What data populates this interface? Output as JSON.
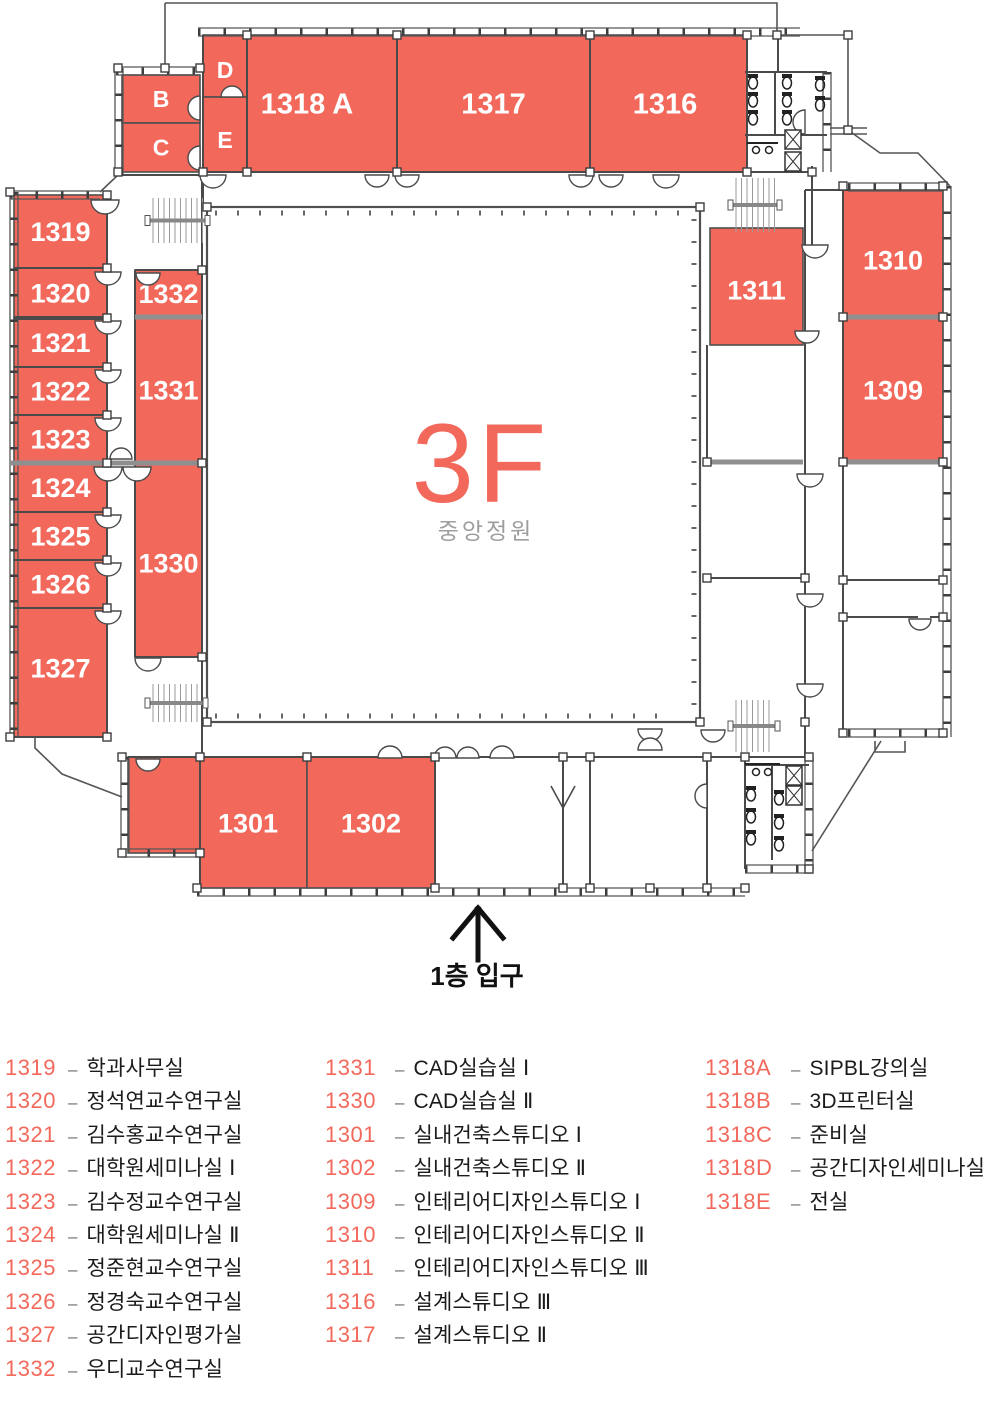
{
  "floor": {
    "big_label": "3F",
    "courtyard_label": "중앙정원",
    "entrance_label": "1층 입구"
  },
  "colors": {
    "room_fill": "#F2695C",
    "wall": "#4a4a4a",
    "gray_wall": "#8f8f8f",
    "room_text": "#ffffff",
    "floor_text": "#F2695C",
    "courtyard_text": "#9e9e9e",
    "legend_number": "#F2695C",
    "legend_name": "#1b1b1b"
  },
  "plan": {
    "rooms": [
      {
        "id": "B",
        "label": "B",
        "x": 122,
        "y": 75,
        "w": 78,
        "h": 48,
        "fs": 23
      },
      {
        "id": "C",
        "label": "C",
        "x": 122,
        "y": 123,
        "w": 78,
        "h": 49,
        "fs": 23
      },
      {
        "id": "D",
        "label": "D",
        "x": 203,
        "y": 35,
        "w": 44,
        "h": 62,
        "fs": 23,
        "ly": 70
      },
      {
        "id": "E",
        "label": "E",
        "x": 203,
        "y": 97,
        "w": 44,
        "h": 75,
        "fs": 23,
        "ly": 140
      },
      {
        "id": "1318A",
        "label": "1318 A",
        "x": 247,
        "y": 35,
        "w": 150,
        "h": 137,
        "fs": 29,
        "lx": 307
      },
      {
        "id": "1317",
        "label": "1317",
        "x": 397,
        "y": 35,
        "w": 193,
        "h": 137,
        "fs": 29
      },
      {
        "id": "1316",
        "label": "1316",
        "x": 590,
        "y": 35,
        "w": 157,
        "h": 137,
        "fs": 29,
        "lx": 665
      },
      {
        "id": "1319",
        "label": "1319",
        "x": 14,
        "y": 195,
        "w": 93,
        "h": 73,
        "fs": 27
      },
      {
        "id": "1320",
        "label": "1320",
        "x": 14,
        "y": 268,
        "w": 93,
        "h": 50,
        "fs": 27
      },
      {
        "id": "1321",
        "label": "1321",
        "x": 14,
        "y": 318,
        "w": 93,
        "h": 49,
        "fs": 27
      },
      {
        "id": "1322",
        "label": "1322",
        "x": 14,
        "y": 367,
        "w": 93,
        "h": 48,
        "fs": 27
      },
      {
        "id": "1323",
        "label": "1323",
        "x": 14,
        "y": 415,
        "w": 93,
        "h": 48,
        "fs": 27
      },
      {
        "id": "1324",
        "label": "1324",
        "x": 14,
        "y": 463,
        "w": 93,
        "h": 49,
        "fs": 27
      },
      {
        "id": "1325",
        "label": "1325",
        "x": 14,
        "y": 512,
        "w": 93,
        "h": 48,
        "fs": 27
      },
      {
        "id": "1326",
        "label": "1326",
        "x": 14,
        "y": 560,
        "w": 93,
        "h": 48,
        "fs": 27
      },
      {
        "id": "1327",
        "label": "1327",
        "x": 14,
        "y": 608,
        "w": 93,
        "h": 129,
        "fs": 27,
        "ly": 668
      },
      {
        "id": "1332",
        "label": "1332",
        "x": 135,
        "y": 270,
        "w": 67,
        "h": 47,
        "fs": 27
      },
      {
        "id": "1331",
        "label": "1331",
        "x": 135,
        "y": 317,
        "w": 67,
        "h": 146,
        "fs": 27,
        "ly": 390
      },
      {
        "id": "1330",
        "label": "1330",
        "x": 135,
        "y": 463,
        "w": 67,
        "h": 194,
        "fs": 27,
        "ly": 563
      },
      {
        "id": "1311",
        "label": "1311",
        "x": 710,
        "y": 228,
        "w": 93,
        "h": 117,
        "fs": 27,
        "ly": 290
      },
      {
        "id": "1310",
        "label": "1310",
        "x": 843,
        "y": 190,
        "w": 100,
        "h": 127,
        "fs": 27,
        "ly": 260
      },
      {
        "id": "1309",
        "label": "1309",
        "x": 843,
        "y": 317,
        "w": 100,
        "h": 145,
        "fs": 27,
        "ly": 390
      },
      {
        "id": "annex",
        "label": "",
        "x": 128,
        "y": 757,
        "w": 72,
        "h": 96
      },
      {
        "id": "1301",
        "label": "1301",
        "x": 200,
        "y": 757,
        "w": 107,
        "h": 131,
        "fs": 27,
        "lx": 248,
        "ly": 823
      },
      {
        "id": "1302",
        "label": "1302",
        "x": 307,
        "y": 757,
        "w": 128,
        "h": 131,
        "fs": 27,
        "ly": 823
      }
    ]
  },
  "legend": {
    "columns": [
      [
        {
          "num": "1319",
          "name": "학과사무실"
        },
        {
          "num": "1320",
          "name": "정석연교수연구실"
        },
        {
          "num": "1321",
          "name": "김수홍교수연구실"
        },
        {
          "num": "1322",
          "name": "대학원세미나실 Ⅰ"
        },
        {
          "num": "1323",
          "name": "김수정교수연구실"
        },
        {
          "num": "1324",
          "name": "대학원세미나실 Ⅱ"
        },
        {
          "num": "1325",
          "name": "정준현교수연구실"
        },
        {
          "num": "1326",
          "name": "정경숙교수연구실"
        },
        {
          "num": "1327",
          "name": "공간디자인평가실"
        },
        {
          "num": "1332",
          "name": "우디교수연구실"
        }
      ],
      [
        {
          "num": "1331",
          "name": "CAD실습실 Ⅰ"
        },
        {
          "num": "1330",
          "name": "CAD실습실 Ⅱ"
        },
        {
          "num": "1301",
          "name": "실내건축스튜디오 Ⅰ"
        },
        {
          "num": "1302",
          "name": "실내건축스튜디오 Ⅱ"
        },
        {
          "num": "1309",
          "name": "인테리어디자인스튜디오 Ⅰ"
        },
        {
          "num": "1310",
          "name": "인테리어디자인스튜디오 Ⅱ"
        },
        {
          "num": "1311",
          "name": "인테리어디자인스튜디오 Ⅲ"
        },
        {
          "num": "1316",
          "name": "설계스튜디오 Ⅲ"
        },
        {
          "num": "1317",
          "name": "설계스튜디오 Ⅱ"
        }
      ],
      [
        {
          "num": "1318A",
          "name": "SIPBL강의실"
        },
        {
          "num": "1318B",
          "name": "3D프린터실"
        },
        {
          "num": "1318C",
          "name": "준비실"
        },
        {
          "num": "1318D",
          "name": "공간디자인세미나실"
        },
        {
          "num": "1318E",
          "name": "전실"
        }
      ]
    ]
  }
}
